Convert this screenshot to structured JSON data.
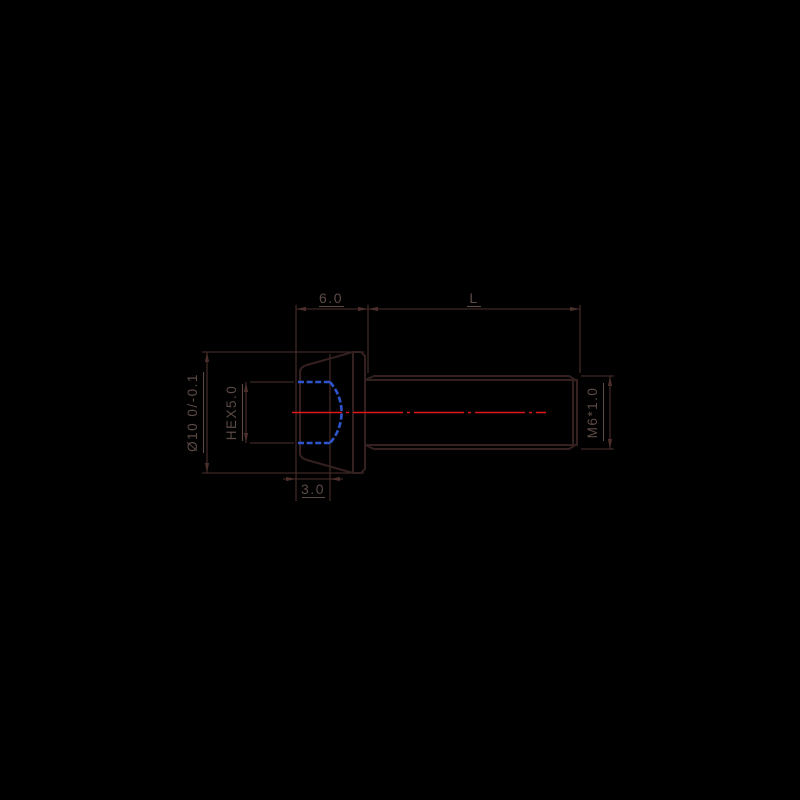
{
  "canvas": {
    "width": 800,
    "height": 800,
    "background": "#000000"
  },
  "drawing": {
    "title": "socket head screw technical drawing",
    "view": "side view with hidden hex socket and centerline",
    "colors": {
      "outline": "#33201f",
      "dimension_lines": "#4b2f2b",
      "label_text": "#5c4a45",
      "centerline_red": "#e01718",
      "hidden_line_blue": "#2e55cd"
    },
    "labels": {
      "head_length": "6.0",
      "shank_length": "L",
      "head_diameter": "Ø10 0/-0.1",
      "hex_socket": "HEX5.0",
      "thread_spec": "M6*1.0",
      "socket_depth": "3.0"
    }
  }
}
